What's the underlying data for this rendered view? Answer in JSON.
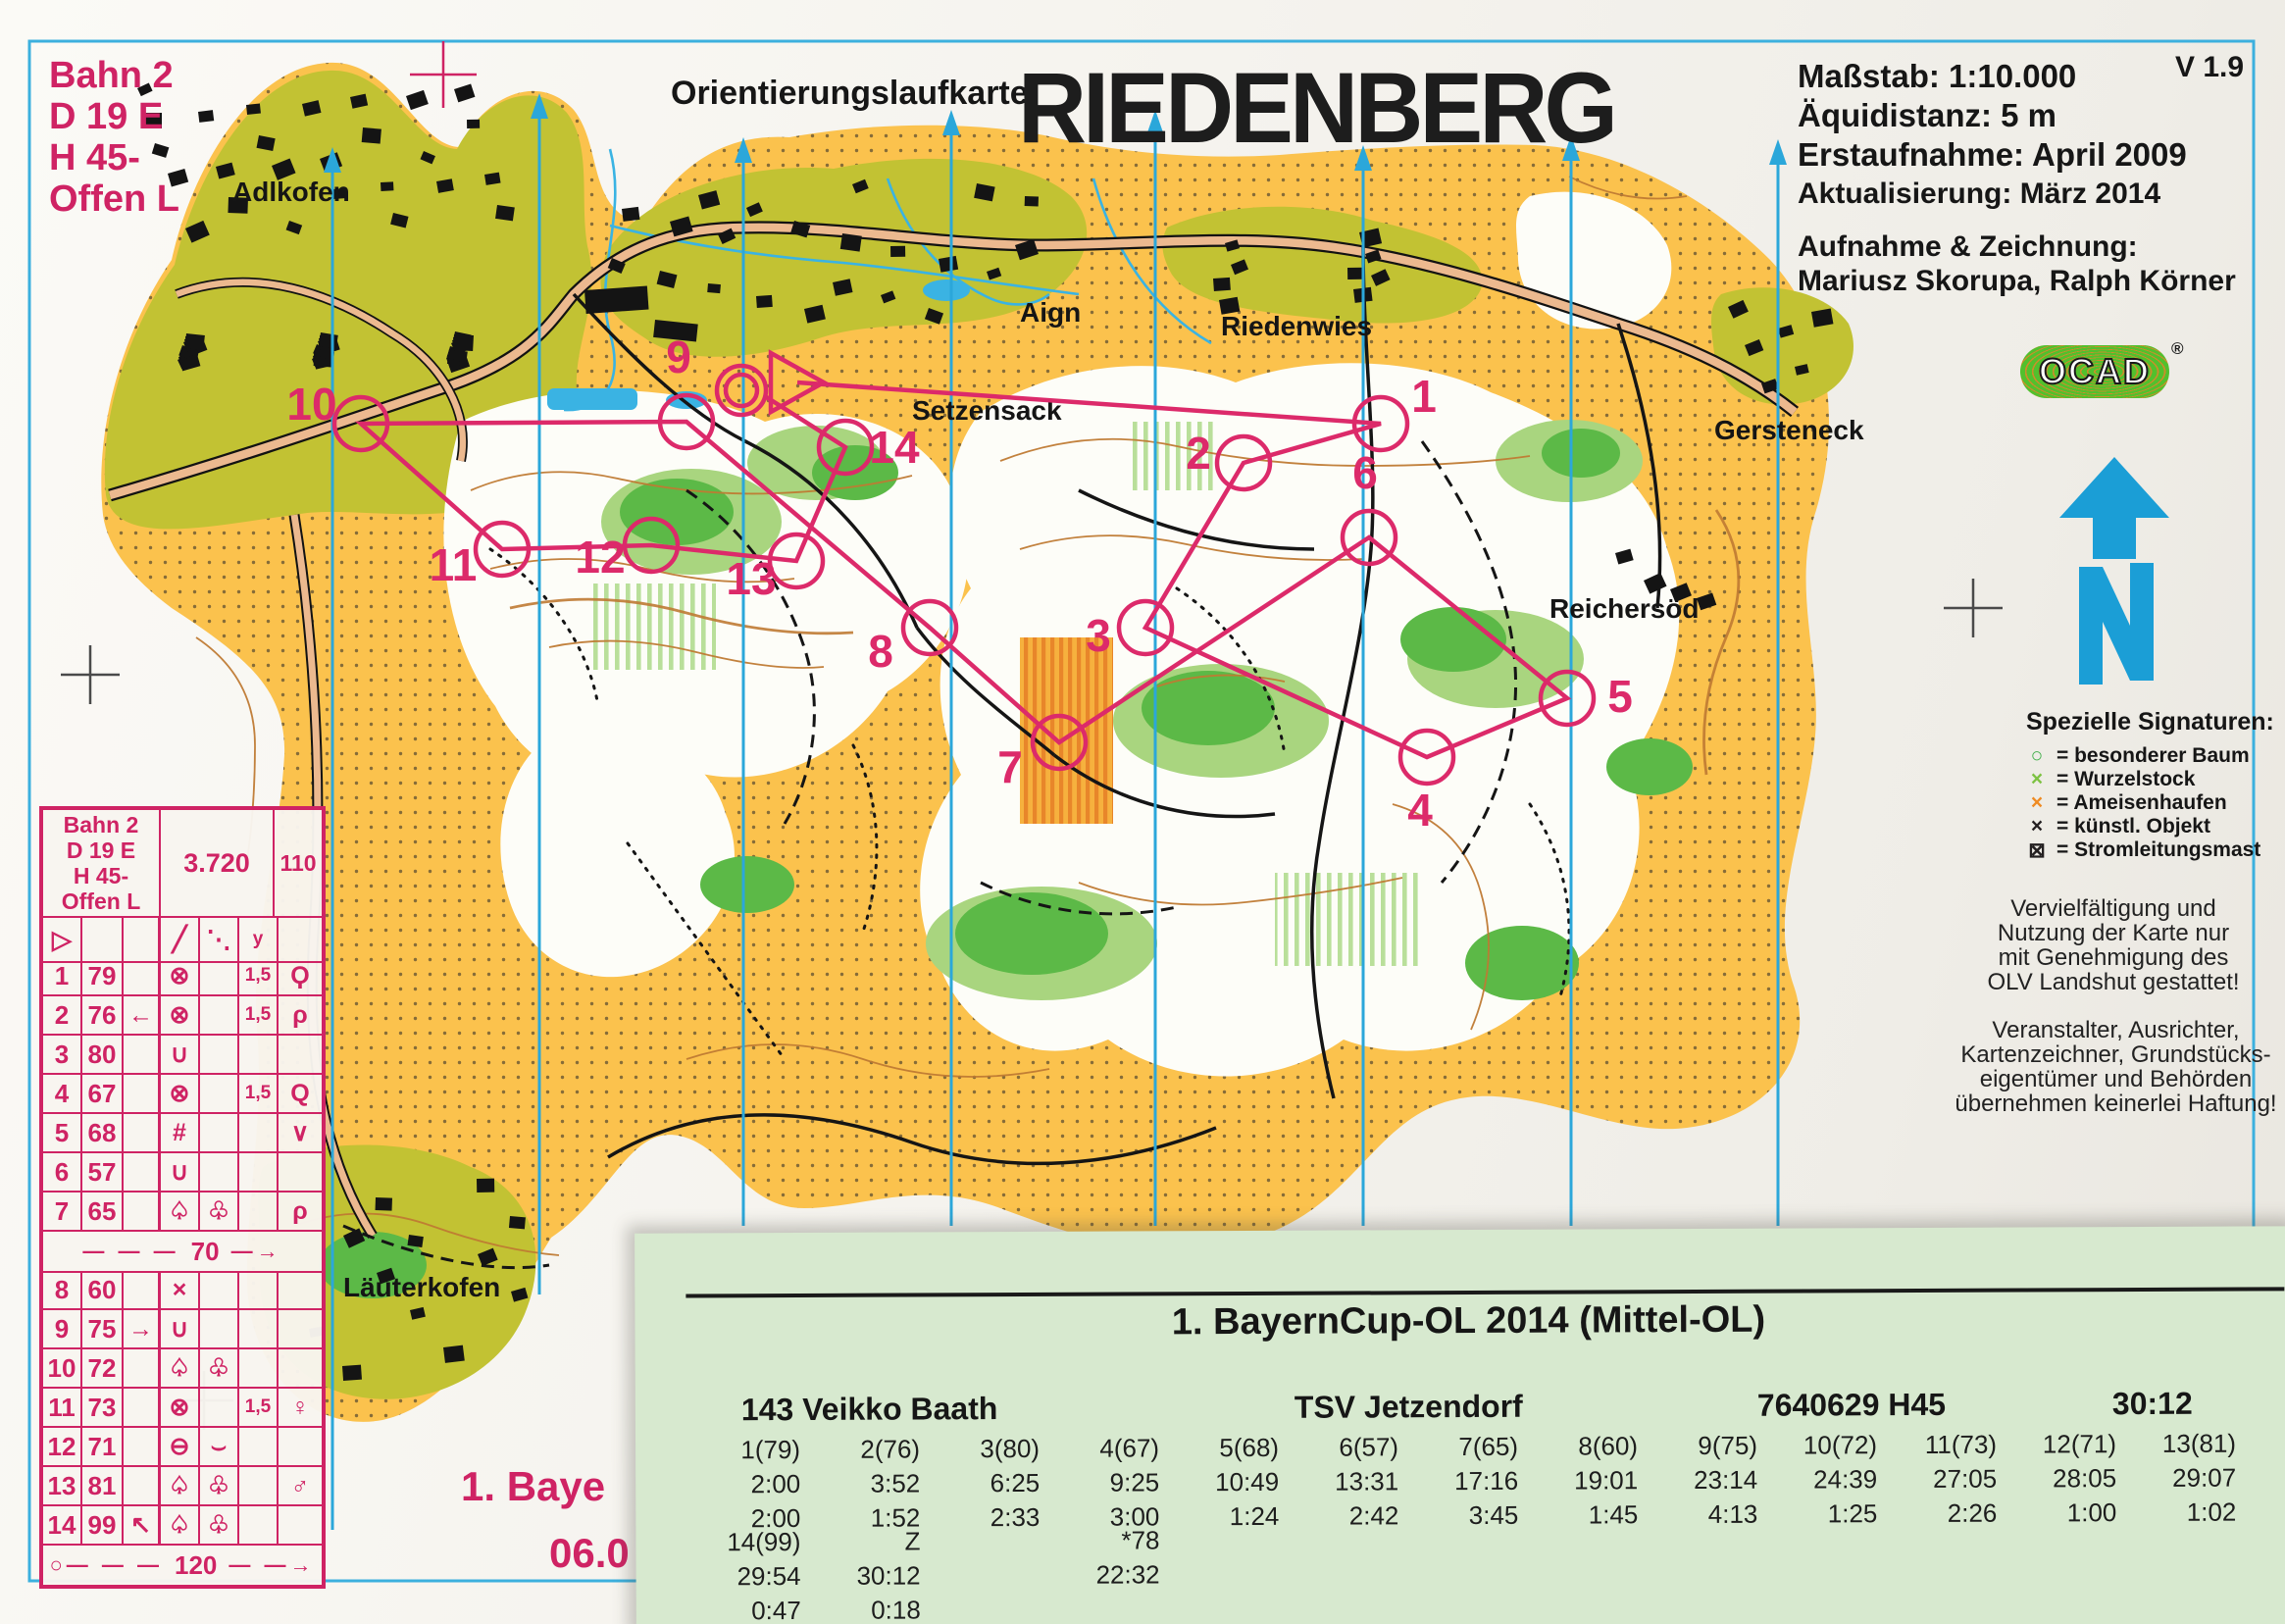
{
  "header": {
    "course_lines": [
      "Bahn 2",
      "D 19 E",
      "H 45-",
      "Offen L"
    ],
    "map_type_label": "Orientierungslaufkarte",
    "title": "RIEDENBERG",
    "version": "V 1.9",
    "info_lines": [
      "Maßstab: 1:10.000",
      "Äquidistanz: 5 m",
      "Erstaufnahme: April 2009",
      "Aktualisierung: März 2014"
    ],
    "credits_heading": "Aufnahme & Zeichnung:",
    "credits_names": "Mariusz Skorupa, Ralph Körner",
    "ocad": "OCAD",
    "ocad_reg": "®"
  },
  "legend": {
    "title": "Spezielle Signaturen:",
    "items": [
      {
        "symbol": "○",
        "color": "#3fae49",
        "label": "= besonderer Baum"
      },
      {
        "symbol": "×",
        "color": "#7dc242",
        "label": "= Wurzelstock"
      },
      {
        "symbol": "×",
        "color": "#ef8b22",
        "label": "= Ameisenhaufen"
      },
      {
        "symbol": "×",
        "color": "#231f20",
        "label": "= künstl. Objekt"
      },
      {
        "symbol": "⊠",
        "color": "#231f20",
        "label": "= Stromleitungsmast"
      }
    ],
    "notice1": [
      "Vervielfältigung und",
      "Nutzung der Karte nur",
      "mit Genehmigung des",
      "OLV Landshut gestattet!"
    ],
    "notice2": [
      "Veranstalter, Ausrichter,",
      "Kartenzeichner, Grundstücks-",
      "eigentümer und Behörden",
      "übernehmen keinerlei Haftung!"
    ]
  },
  "control_sheet": {
    "course": [
      "Bahn 2",
      "D 19 E",
      "H 45-",
      "Offen L"
    ],
    "length": "3.720",
    "climb": "110",
    "header_row": [
      "▷",
      "",
      "",
      "╱",
      "⋱",
      "y",
      ""
    ],
    "rows": [
      [
        "1",
        "79",
        "",
        "⊗",
        "",
        "1,5",
        "Ϙ"
      ],
      [
        "2",
        "76",
        "←",
        "⊗",
        "",
        "1,5",
        "ρ"
      ],
      [
        "3",
        "80",
        "",
        "∪",
        "",
        "",
        ""
      ],
      [
        "4",
        "67",
        "",
        "⊗",
        "",
        "1,5",
        "Q"
      ],
      [
        "5",
        "68",
        "",
        "#",
        "",
        "",
        "∨"
      ],
      [
        "6",
        "57",
        "",
        "∪",
        "",
        "",
        ""
      ],
      [
        "7",
        "65",
        "",
        "♤",
        "♧",
        "",
        "ρ"
      ],
      [
        "8",
        "60",
        "",
        "×",
        "",
        "",
        ""
      ],
      [
        "9",
        "75",
        "→",
        "∪",
        "",
        "",
        ""
      ],
      [
        "10",
        "72",
        "",
        "♤",
        "♧",
        "",
        ""
      ],
      [
        "11",
        "73",
        "",
        "⊗",
        "",
        "1,5",
        "♀"
      ],
      [
        "12",
        "71",
        "",
        "⊖",
        "⌣",
        "",
        ""
      ],
      [
        "13",
        "81",
        "",
        "♤",
        "♧",
        "",
        "♂"
      ],
      [
        "14",
        "99",
        "↖",
        "♤",
        "♧",
        "",
        ""
      ]
    ],
    "divider_70": {
      "prefix": "— — —",
      "value": "70",
      "suffix": "—→"
    },
    "divider_120": {
      "prefix": "○— — —",
      "value": "120",
      "suffix": "— —→"
    }
  },
  "map": {
    "labels": [
      {
        "text": "Adlkofen"
      },
      {
        "text": "Aign"
      },
      {
        "text": "Riedenwies"
      },
      {
        "text": "Setzensack"
      },
      {
        "text": "Gersteneck"
      },
      {
        "text": "Reichersöd"
      },
      {
        "text": "Läuterkofen"
      }
    ],
    "course_numbers": [
      "1",
      "2",
      "3",
      "4",
      "5",
      "6",
      "7",
      "8",
      "9",
      "10",
      "11",
      "12",
      "13",
      "14"
    ],
    "event_text_partial": "1. Baye",
    "event_date_partial": "06.0",
    "colors": {
      "open_land_yellow": "#fbc24d",
      "settlement_olive": "#c2c233",
      "forest_white": "#fdfdf8",
      "vegetation_green": "#5cb947",
      "water_cyan": "#3ab3e3",
      "contour_brown": "#bf7a33",
      "course_magenta": "#dc2a6a",
      "meridian_cyan": "#2ba7da",
      "slip_green": "#d7e9cf"
    }
  },
  "results": {
    "title": "1. BayernCup-OL 2014 (Mittel-OL)",
    "bib_name": "143 Veikko Baath",
    "club": "TSV Jetzendorf",
    "card_class": "7640629 H45",
    "total_time": "30:12",
    "controls": [
      "1(79)",
      "2(76)",
      "3(80)",
      "4(67)",
      "5(68)",
      "6(57)",
      "7(65)",
      "8(60)",
      "9(75)",
      "10(72)",
      "11(73)",
      "12(71)",
      "13(81)"
    ],
    "cumulative": [
      "2:00",
      "3:52",
      "6:25",
      "9:25",
      "10:49",
      "13:31",
      "17:16",
      "19:01",
      "23:14",
      "24:39",
      "27:05",
      "28:05",
      "29:07"
    ],
    "legs": [
      "2:00",
      "1:52",
      "2:33",
      "3:00",
      "1:24",
      "2:42",
      "3:45",
      "1:45",
      "4:13",
      "1:25",
      "2:26",
      "1:00",
      "1:02"
    ],
    "tail_rows": [
      [
        "14(99)",
        "Z",
        "",
        "*78",
        "",
        "",
        "",
        "",
        "",
        "",
        "",
        "",
        ""
      ],
      [
        "29:54",
        "30:12",
        "",
        "22:32",
        "",
        "",
        "",
        "",
        "",
        "",
        "",
        "",
        ""
      ],
      [
        "0:47",
        "0:18",
        "",
        "",
        "",
        "",
        "",
        "",
        "",
        "",
        "",
        "",
        ""
      ]
    ]
  }
}
